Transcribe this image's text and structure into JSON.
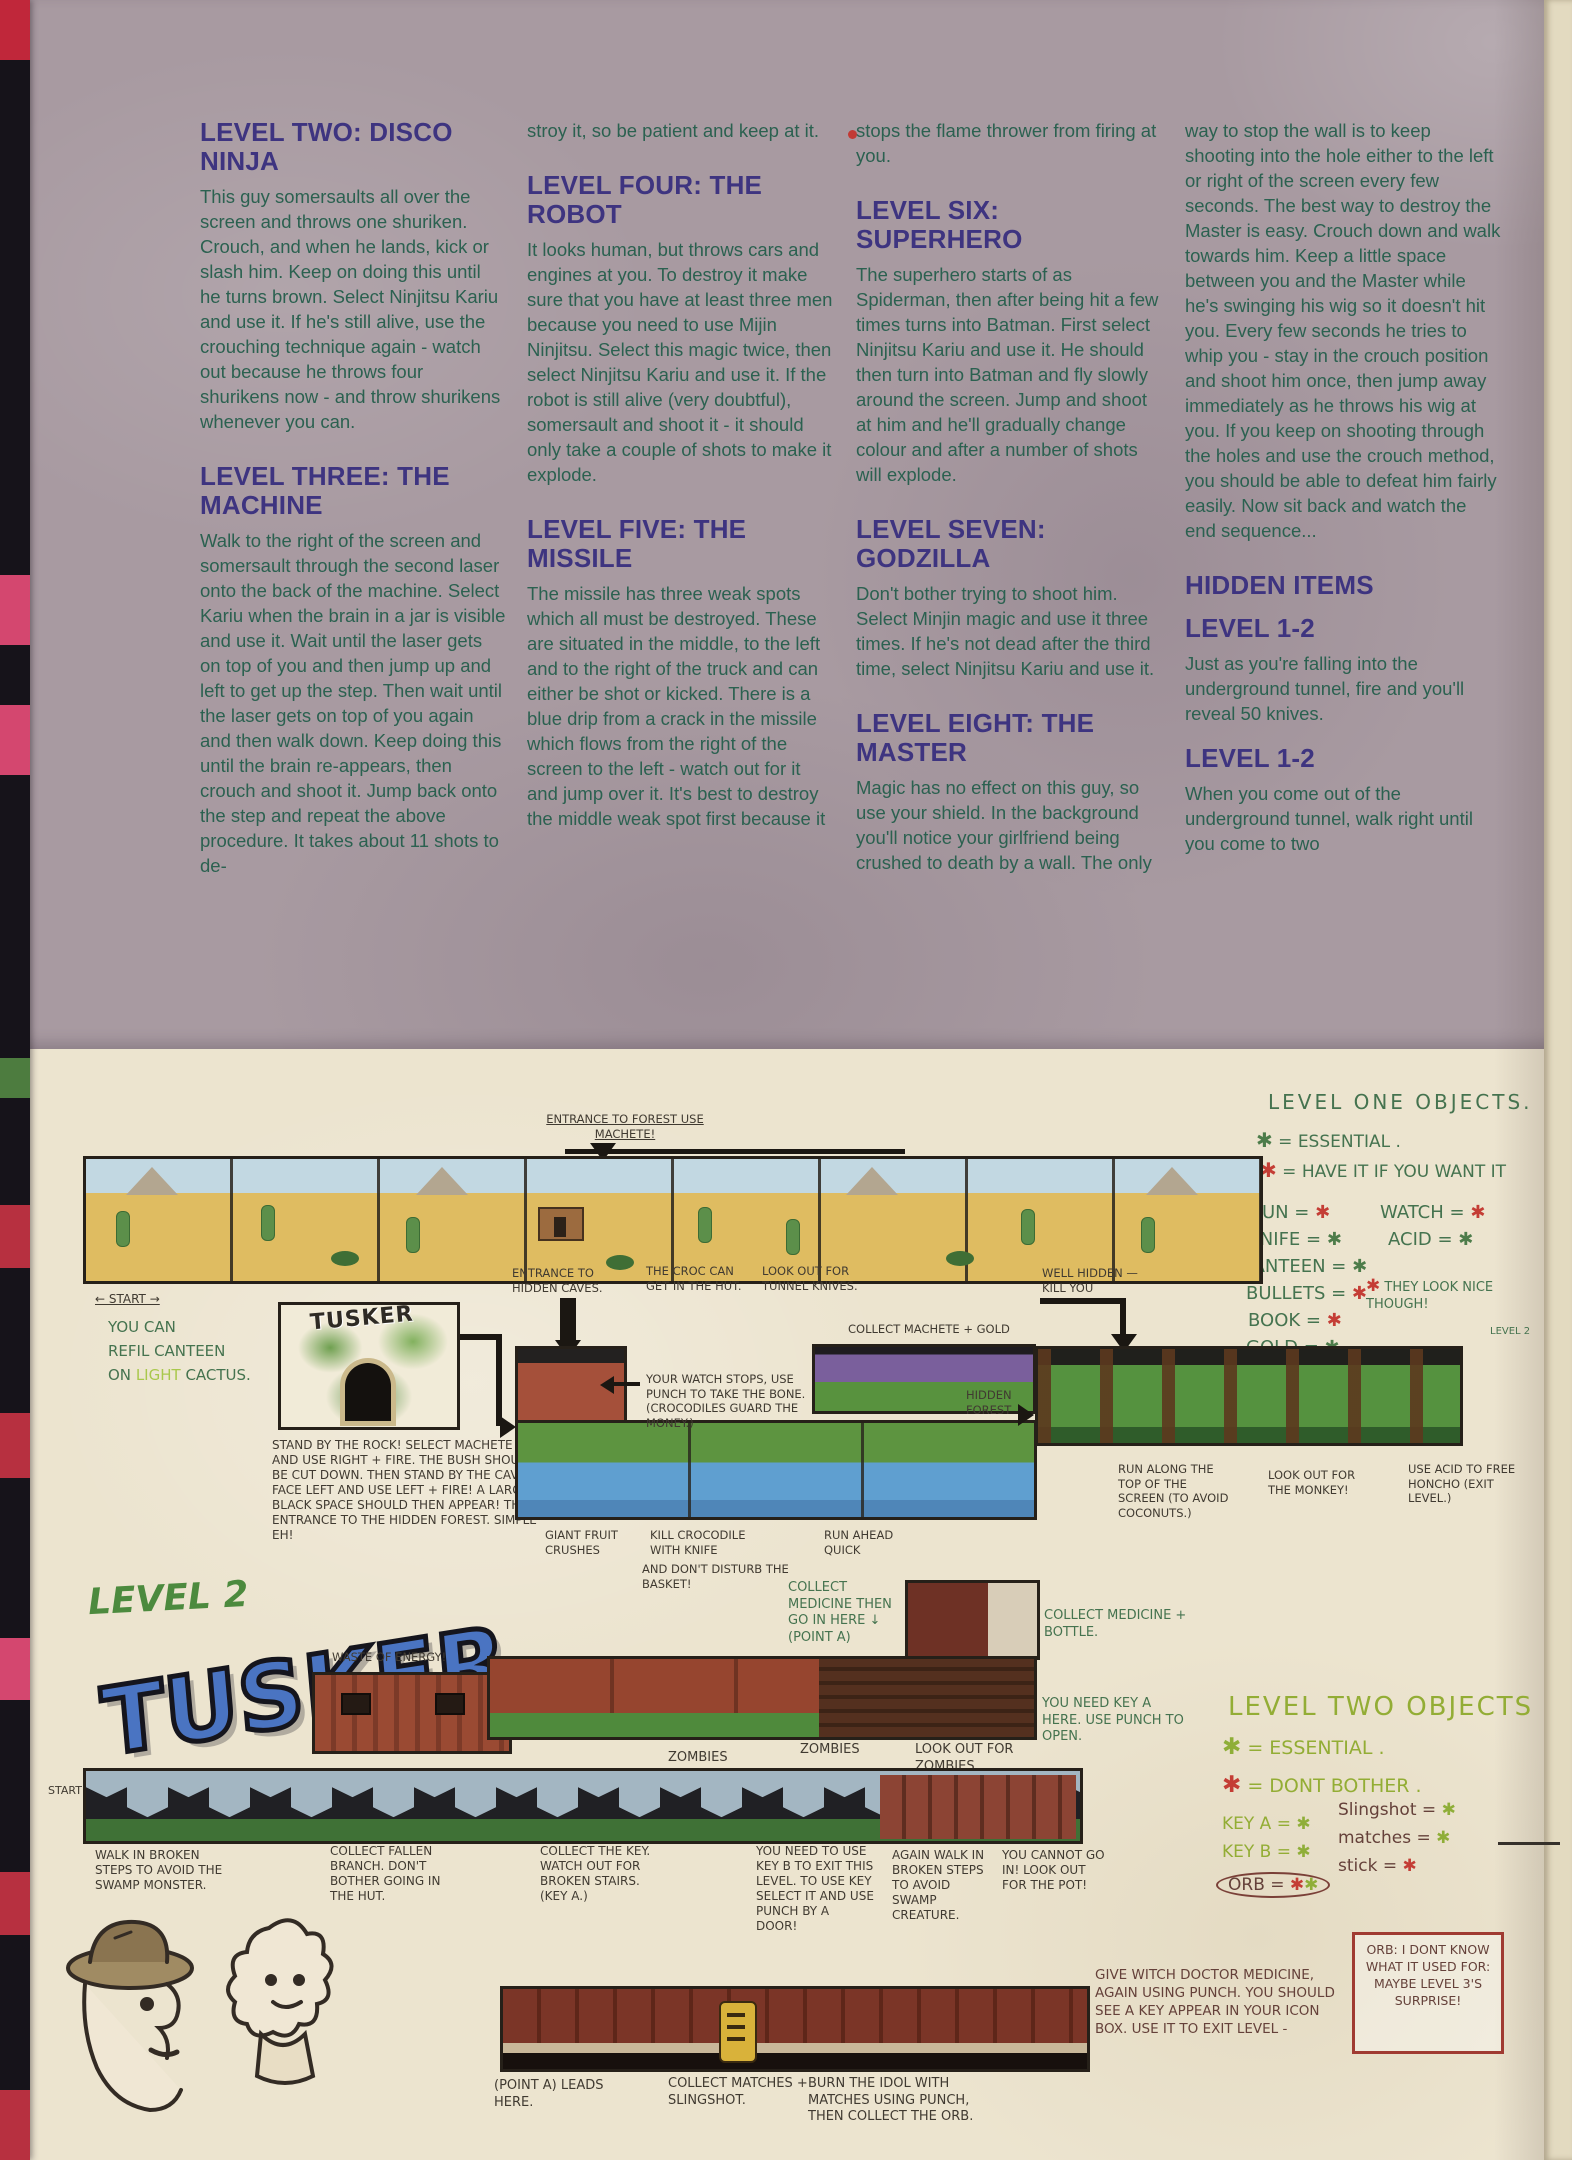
{
  "colors": {
    "heading_purple": "#3e3480",
    "body_green": "#2b6150",
    "ink_green": "#45734f",
    "ink_black": "#403a31",
    "ink_red": "#bf3f37",
    "marker_lime": "#93ad35",
    "paper_top": "#a89aa1",
    "paper_bottom": "#ece4cf",
    "essential_red": "#c43d35",
    "optional_green": "#4d7c4a"
  },
  "icons": {
    "asterisk": "✱",
    "arrow_right": "→",
    "arrow_left": "←",
    "arrow_down": "↓"
  },
  "article": {
    "col1": {
      "h1": "LEVEL TWO: DISCO NINJA",
      "p1": "This guy somersaults all over the screen and throws one shuriken. Crouch, and when he lands, kick or slash him. Keep on doing this until he turns brown. Select Ninjitsu Kariu and use it. If he's still alive, use the crouching technique again - watch out because he throws four shurikens now - and throw shurikens whenever you can.",
      "h2": "LEVEL THREE: THE MACHINE",
      "p2": "Walk to the right of the screen and somersault through the second laser onto the back of the machine. Select Kariu when the brain in a jar is visible and use it. Wait until the laser gets on top of you and then jump up and left to get up the step. Then wait until the laser gets on top of you again and then walk down. Keep doing this until the brain re-appears, then crouch and shoot it. Jump back onto the step and repeat the above procedure. It takes about 11 shots to de-"
    },
    "col2": {
      "p0": "stroy it, so be patient and keep at it.",
      "h1": "LEVEL FOUR: THE ROBOT",
      "p1": "It looks human, but throws cars and engines at you. To destroy it make sure that you have at least three men because you need to use Mijin Ninjitsu. Select this magic twice, then select Ninjitsu Kariu and use it. If the robot is still alive (very doubtful), somersault and shoot it - it should only take a couple of shots to make it explode.",
      "h2": "LEVEL FIVE: THE MISSILE",
      "p2": "The missile has three weak spots which all must be destroyed. These are situated in the middle, to the left and to the right of the truck and can either be shot or kicked. There is a blue drip from a crack in the missile which flows from the right of the screen to the left - watch out for it and jump over it. It's best to destroy the middle weak spot first because it"
    },
    "col3": {
      "p0": "stops the flame thrower from firing at you.",
      "h1": "LEVEL SIX: SUPERHERO",
      "p1": "The superhero starts of as Spiderman, then after being hit a few times turns into Batman. First select Ninjitsu Kariu and use it. He should then turn into Batman and fly slowly around the screen. Jump and shoot at him and he'll gradually change colour and after a number of shots will explode.",
      "h2": "LEVEL SEVEN: GODZILLA",
      "p2": "Don't bother trying to shoot him. Select Minjin magic and use it three times. If he's not dead after the third time, select Ninjitsu Kariu and use it.",
      "h3": "LEVEL EIGHT: THE MASTER",
      "p3": "Magic has no effect on this guy, so use your shield. In the background you'll notice your girlfriend being crushed to death by a wall. The only"
    },
    "col4": {
      "p0": "way to stop the wall is to keep shooting into the hole either to the left or right of the screen every few seconds. The best way to destroy the Master is easy. Crouch down and walk towards him. Keep a little space between you and the Master while he's swinging his wig so it doesn't hit you. Every few seconds he tries to whip you - stay in the crouch position and shoot him once, then jump away immediately as he throws his wig at you. If you keep on shooting through the holes and use the crouch method, you should be able to defeat him fairly easily. Now sit back and watch the end sequence...",
      "h1": "HIDDEN ITEMS",
      "h2": "LEVEL 1-2",
      "p1": "Just as you're falling into the underground tunnel, fire and you'll reveal 50 knives.",
      "h3": "LEVEL 1-2",
      "p2": "When you come out of the underground tunnel, walk right until you come to two"
    }
  },
  "level1": {
    "objects": {
      "title": "LEVEL ONE OBJECTS.",
      "essential_label": "= ESSENTIAL .",
      "want_label": "= HAVE IT IF YOU WANT IT",
      "items_left": [
        {
          "label": "GUN ="
        },
        {
          "label": "KNIFE ="
        },
        {
          "label": "CANTEEN ="
        },
        {
          "label": "BULLETS ="
        },
        {
          "label": "BOOK ="
        },
        {
          "label": "GOLD ="
        },
        {
          "label": "MACHETE ="
        }
      ],
      "items_right": [
        {
          "label": "WATCH ="
        },
        {
          "label": "ACID ="
        }
      ],
      "nice_note": "THEY LOOK NICE THOUGH!"
    },
    "map": {
      "entrance_forest": "ENTRANCE TO FOREST USE MACHETE!",
      "start": "← START →",
      "refill_line1": "YOU CAN",
      "refill_line2": "REFIL CANTEEN",
      "refill_on": "ON",
      "refill_light": "LIGHT",
      "refill_cactus": "CACTUS.",
      "tusker_label": "TUSKER",
      "rock_caption": "STAND BY THE ROCK! SELECT MACHETE AND USE RIGHT + FIRE. THE BUSH SHOULD BE CUT DOWN. THEN STAND BY THE CAVE, FACE LEFT AND USE LEFT + FIRE! A LARGE BLACK SPACE SHOULD THEN APPEAR! THE ENTRANCE TO THE HIDDEN FOREST. SIMPLE EH!",
      "entrance_caves": "ENTRANCE TO HIDDEN CAVES.",
      "croc_hut": "THE CROC CAN GET IN THE HUT.",
      "tunnel_knives": "LOOK OUT FOR TUNNEL KNIVES.",
      "watch_stops": "YOUR WATCH STOPS, USE PUNCH TO TAKE THE BONE. (CROCODILES GUARD THE MONEY.)",
      "collect_machete": "COLLECT MACHETE + GOLD",
      "well_hidden": "WELL HIDDEN — KILL YOU",
      "giant_fruit": "GIANT FRUIT CRUSHES",
      "kill_croc": "KILL CROCODILE WITH KNIFE",
      "dont_disturb": "AND DON'T DISTURB THE BASKET!",
      "run_ahead": "RUN AHEAD QUICK",
      "hidden_forest": "HIDDEN FOREST",
      "run_top": "RUN ALONG THE TOP OF THE SCREEN (TO AVOID COCONUTS.)",
      "monkey": "LOOK OUT FOR THE MONKEY!",
      "acid_free": "USE ACID TO FREE HONCHO (EXIT LEVEL.)",
      "level2_marker": "LEVEL 2"
    }
  },
  "level2": {
    "script_title": "LEVEL 2",
    "logo": "TUSKER",
    "waste": "WASTE OF ENERGY!",
    "door": "THE DOOR LEADS HERE. →",
    "med_here": "COLLECT MEDICINE THEN GO IN HERE ↓ (POINT A)",
    "med_bottle": "COLLECT MEDICINE + BOTTLE.",
    "key_a_door": "YOU NEED KEY A HERE. USE PUNCH TO OPEN.",
    "zombies_1": "ZOMBIES",
    "zombies_2": "ZOMBIES",
    "zombies_lookout": "LOOK OUT FOR ZOMBIES",
    "start": "START",
    "walk_broken": "WALK IN BROKEN STEPS TO AVOID THE SWAMP MONSTER.",
    "branch": "COLLECT FALLEN BRANCH. DON'T BOTHER GOING IN THE HUT.",
    "collect_key": "COLLECT THE KEY. WATCH OUT FOR BROKEN STAIRS. (KEY A.)",
    "key_b": "YOU NEED TO USE KEY B TO EXIT THIS LEVEL. TO USE KEY SELECT IT AND USE PUNCH BY A DOOR!",
    "again_walk": "AGAIN WALK IN BROKEN STEPS TO AVOID SWAMP CREATURE.",
    "cannot_go": "YOU CANNOT GO IN! LOOK OUT FOR THE POT!",
    "witch": "GIVE WITCH DOCTOR MEDICINE, AGAIN USING PUNCH. YOU SHOULD SEE A KEY APPEAR IN YOUR ICON BOX. USE IT TO EXIT LEVEL -",
    "orb_note": "ORB: I DONT KNOW WHAT IT USED FOR: MAYBE LEVEL 3'S SURPRISE!",
    "point_a": "(POINT A) LEADS HERE.",
    "collect_matches": "COLLECT MATCHES + SLINGSHOT.",
    "burn_orb": "BURN THE IDOL WITH MATCHES USING PUNCH, THEN COLLECT THE ORB.",
    "objects": {
      "title": "LEVEL TWO OBJECTS",
      "essential": "= ESSENTIAL .",
      "dont": "= DONT BOTHER .",
      "key_a": "KEY A =",
      "key_b": "KEY B =",
      "orb": "ORB =",
      "slingshot": "Slingshot =",
      "matches": "matches =",
      "stick": "stick ="
    }
  }
}
